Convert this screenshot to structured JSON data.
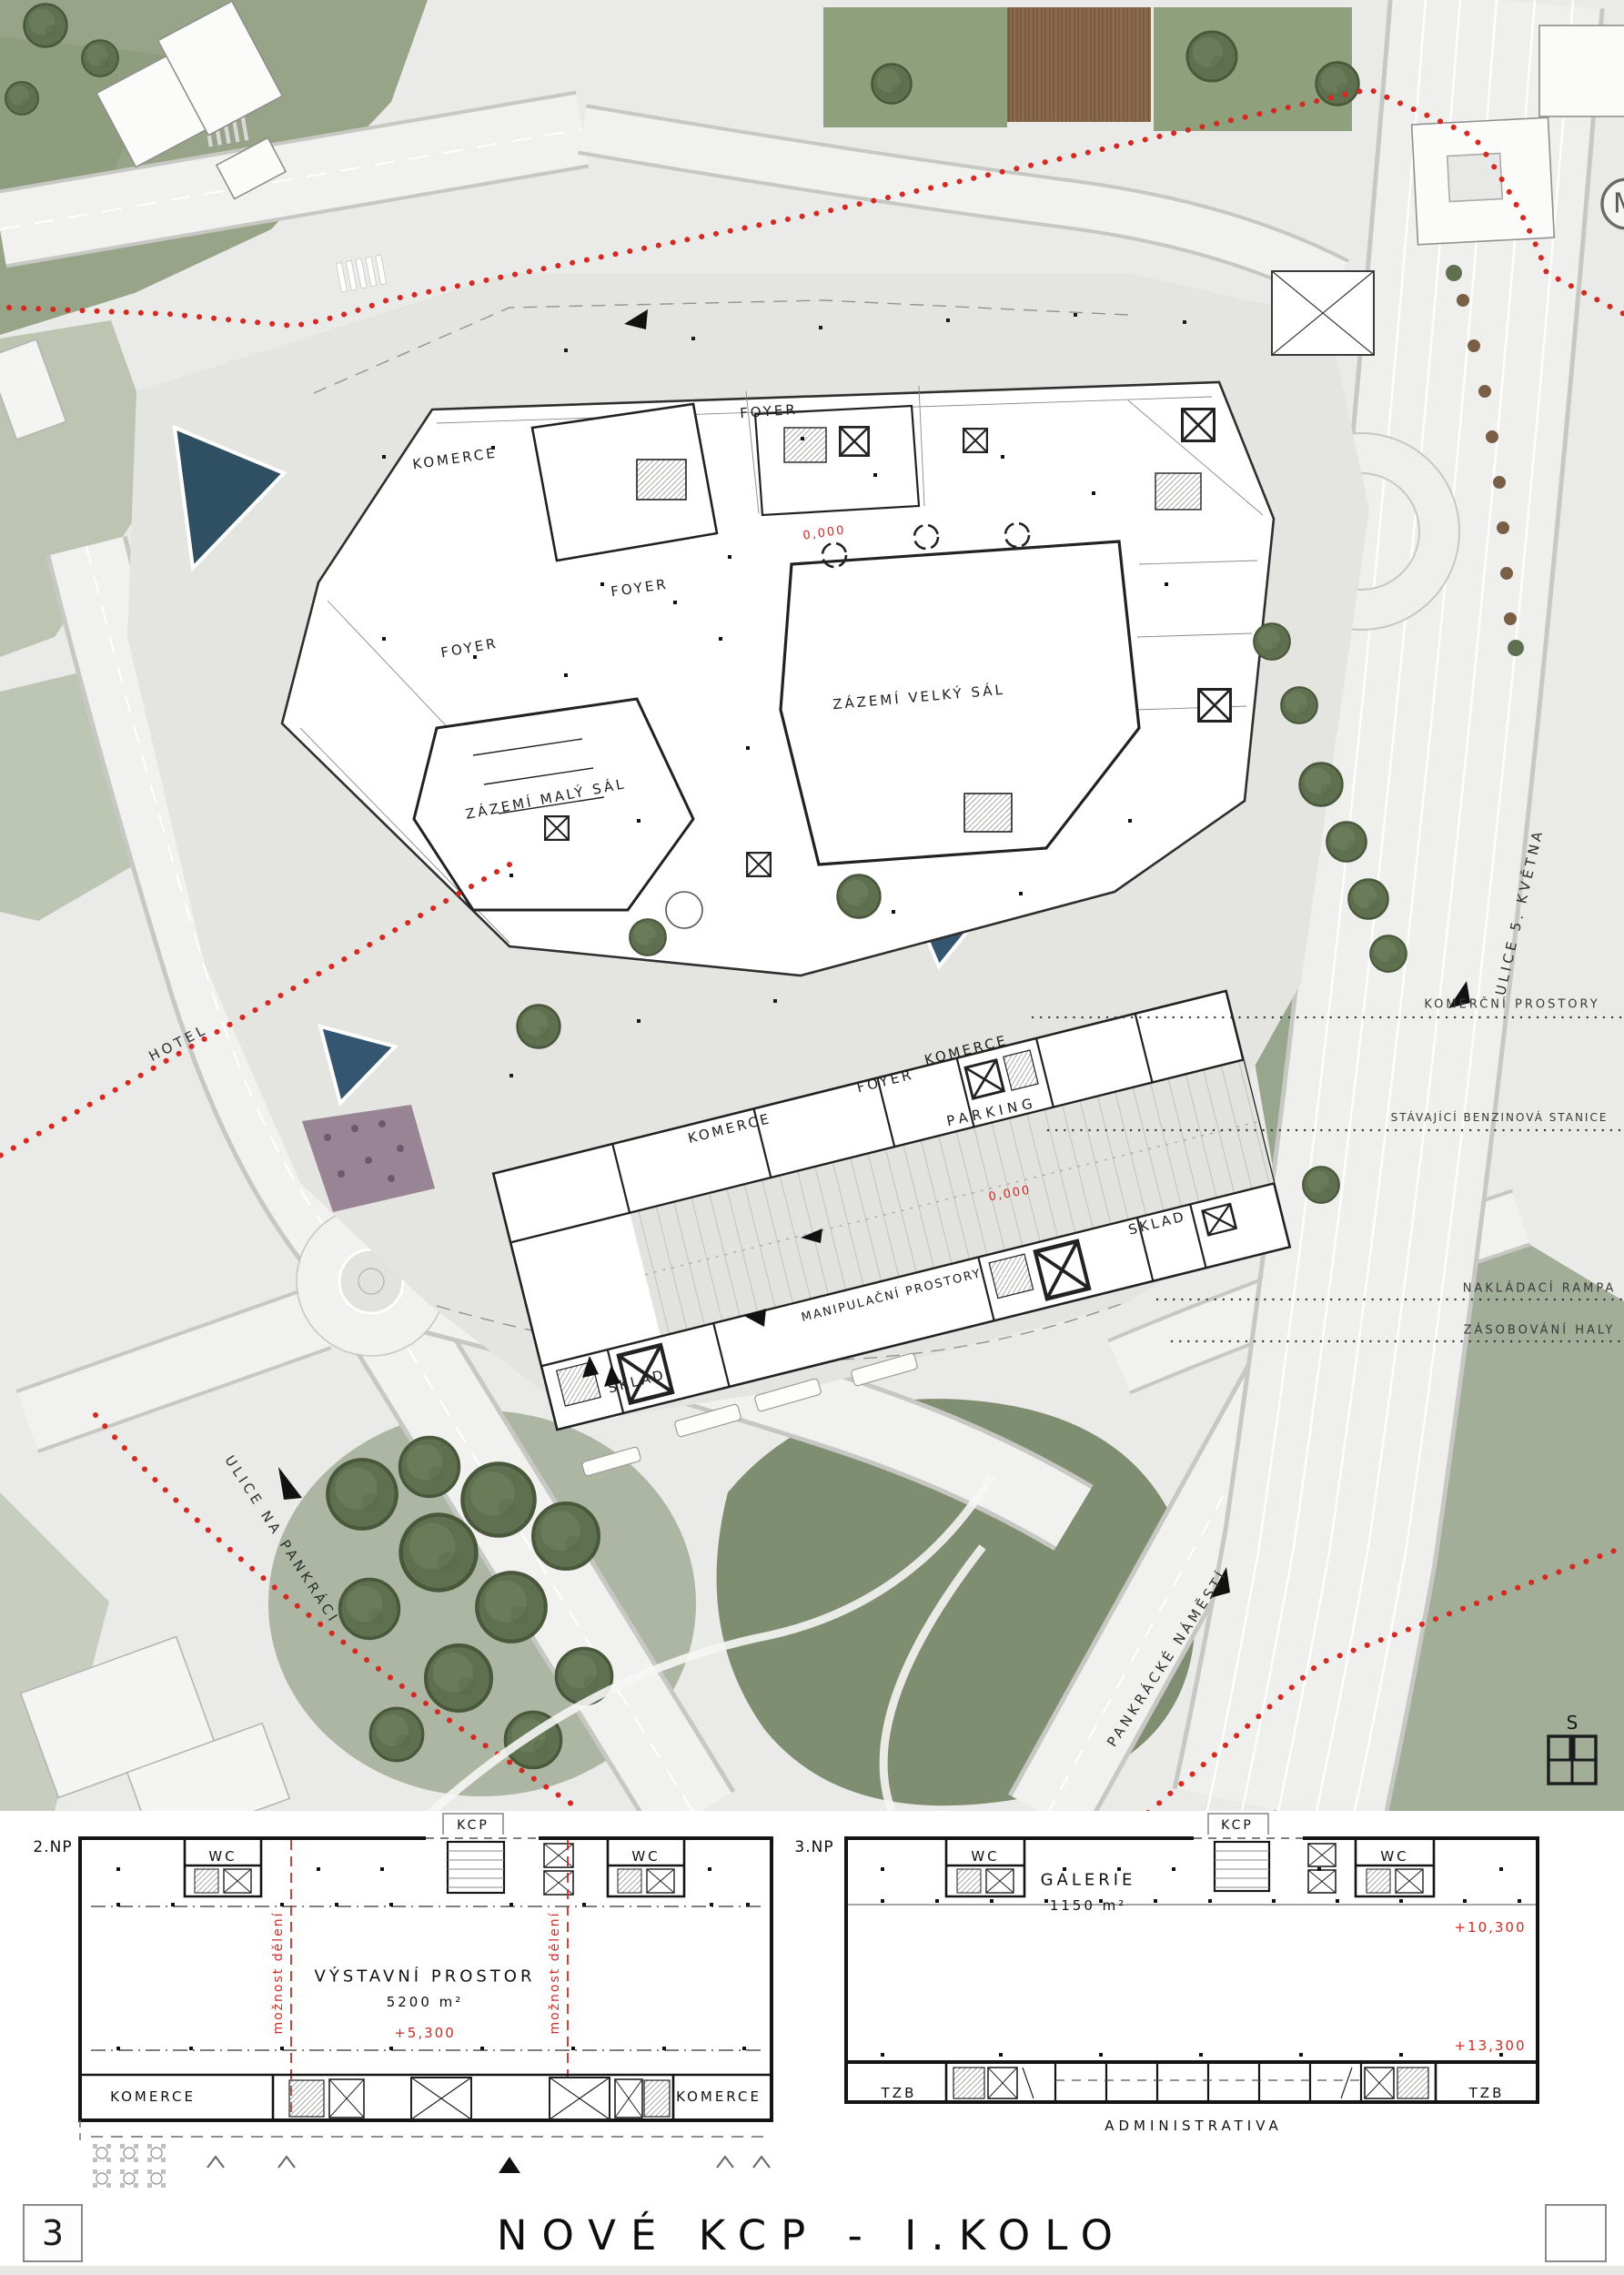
{
  "board": {
    "sheet_number": "3",
    "title": "NOVÉ KCP - I.KOLO"
  },
  "colors": {
    "paper": "#eaebe8",
    "plaza": "#e4e4e1",
    "road": "#f1f1ef",
    "road_edge": "#c7c7c4",
    "green": "#97a487",
    "green_dark": "#77876a",
    "tree": "#5f7050",
    "water": "#2f4f63",
    "deck_brown": "#8a6a4d",
    "accent_red": "#cf2a24",
    "ink": "#222222"
  },
  "site_plan": {
    "buildings": {
      "komerce_nw": "KOMERCE",
      "foyer_top": "FOYER",
      "foyer_mid": "FOYER",
      "foyer_left": "FOYER",
      "zazemi_velky_sal": "ZÁZEMÍ VELKÝ SÁL",
      "zazemi_maly_sal": "ZÁZEMÍ MALÝ SÁL",
      "level_main": "0,000"
    },
    "parking_strip": {
      "komerce_left": "KOMERCE",
      "foyer": "FOYER",
      "komerce_right": "KOMERCE",
      "parking": "PARKING",
      "level": "0,000",
      "sklad_right": "SKLAD",
      "sklad_left": "SKLAD",
      "manipulacni_prostory": "MANIPULAČNÍ PROSTORY"
    },
    "streets": {
      "hotel": "HOTEL",
      "ulice_na_pankraci": "ULICE NA PANKRÁCI",
      "pankracke_namesti": "PANKRÁCKÉ NÁMĚSTÍ",
      "ulice_5_kvetna": "ULICE 5. KVĚTNA"
    },
    "guides": {
      "komercni_prostory": "KOMERČNÍ PROSTORY",
      "stavajici_benzinova_stanice": "STÁVAJÍCÍ BENZINOVÁ STANICE",
      "nakladaci_rampa": "NAKLÁDACÍ RAMPA",
      "zasobovani_haly": "ZÁSOBOVÁNÍ HALY"
    },
    "symbols": {
      "metro": "M",
      "north": "S"
    }
  },
  "floor_plans": {
    "np2": {
      "level": "2.NP",
      "kcp": "KCP",
      "wc_left": "WC",
      "wc_right": "WC",
      "room": "VÝSTAVNÍ PROSTOR",
      "area": "5200 m²",
      "elevation": "+5,300",
      "division_left": "možnost dělení",
      "division_right": "možnost dělení",
      "komerce_left": "KOMERCE",
      "komerce_right": "KOMERCE"
    },
    "np3": {
      "level": "3.NP",
      "kcp": "KCP",
      "wc_left": "WC",
      "wc_right": "WC",
      "room": "GALERIE",
      "area": "1150 m²",
      "elevation_upper": "+10,300",
      "elevation_lower": "+13,300",
      "tzb_left": "TZB",
      "tzb_right": "TZB",
      "administrativa": "ADMINISTRATIVA"
    }
  }
}
